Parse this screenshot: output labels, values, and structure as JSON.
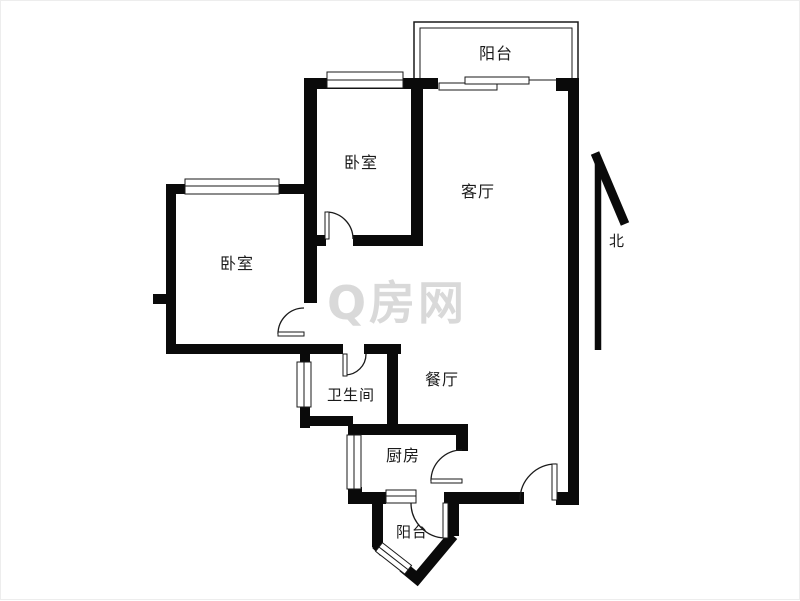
{
  "title": "apartment-floor-plan",
  "colors": {
    "wall": "#0a0a0a",
    "background": "#ffffff",
    "watermark": "#d9d9d9",
    "label": "#1a1a1a"
  },
  "watermark": {
    "text": "Q房网"
  },
  "compass": {
    "label": "北"
  },
  "rooms": [
    {
      "id": "balcony-top",
      "label": "阳台"
    },
    {
      "id": "bedroom-top",
      "label": "卧室"
    },
    {
      "id": "living-room",
      "label": "客厅"
    },
    {
      "id": "bedroom-left",
      "label": "卧室"
    },
    {
      "id": "dining-room",
      "label": "餐厅"
    },
    {
      "id": "bathroom",
      "label": "卫生间"
    },
    {
      "id": "kitchen",
      "label": "厨房"
    },
    {
      "id": "balcony-bottom",
      "label": "阳台"
    }
  ]
}
